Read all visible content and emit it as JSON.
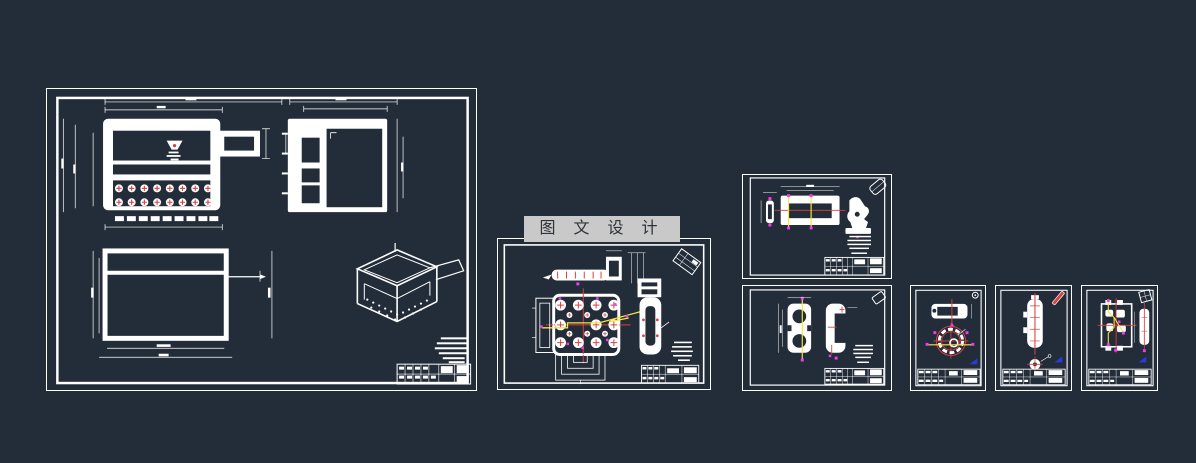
{
  "canvas": {
    "width": 1196,
    "height": 463
  },
  "palette": {
    "bg": "#232c39",
    "line": "#ffffff",
    "red": "#d94040",
    "yellow": "#f8e53c",
    "mag": "#ee3cee",
    "blue": "#2a3bdd",
    "wm_bg": "#c8c9c8",
    "wm_fg": "#2f3237"
  },
  "watermark": {
    "text": "图 文 设 计"
  },
  "sheets": [
    {
      "id": "sheet-1"
    },
    {
      "id": "sheet-2"
    },
    {
      "id": "sheet-3"
    },
    {
      "id": "sheet-4"
    },
    {
      "id": "sheet-5"
    },
    {
      "id": "sheet-6"
    },
    {
      "id": "sheet-7"
    }
  ]
}
